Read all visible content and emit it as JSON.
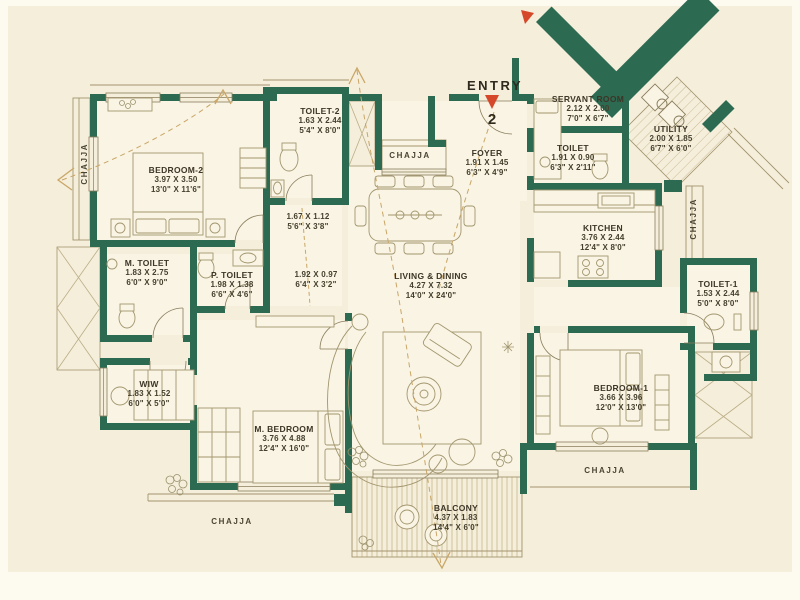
{
  "plan": {
    "entry": {
      "label": "ENTRY",
      "number": "2"
    },
    "rooms": [
      {
        "id": "bedroom-2",
        "name": "BEDROOM-2",
        "metric": "3.97 X 3.50",
        "imperial": "13'0\" X 11'6\""
      },
      {
        "id": "toilet-2",
        "name": "TOILET-2",
        "metric": "1.63 X 2.44",
        "imperial": "5'4\" X 8'0\""
      },
      {
        "id": "servant-room",
        "name": "SERVANT ROOM",
        "metric": "2.12 X 2.00",
        "imperial": "7'0\" X 6'7\""
      },
      {
        "id": "foyer",
        "name": "FOYER",
        "metric": "1.91 X 1.45",
        "imperial": "6'3\" X 4'9\""
      },
      {
        "id": "toilet",
        "name": "TOILET",
        "metric": "1.91 X 0.90",
        "imperial": "6'3\" X 2'11\""
      },
      {
        "id": "utility",
        "name": "UTILITY",
        "metric": "2.00 X 1.85",
        "imperial": "6'7\" X 6'0\""
      },
      {
        "id": "kitchen",
        "name": "KITCHEN",
        "metric": "3.76 X 2.44",
        "imperial": "12'4\" X 8'0\""
      },
      {
        "id": "toilet-1",
        "name": "TOILET-1",
        "metric": "1.53 X 2.44",
        "imperial": "5'0\" X 8'0\""
      },
      {
        "id": "bedroom-1",
        "name": "BEDROOM-1",
        "metric": "3.66 X 3.96",
        "imperial": "12'0\" X 13'0\""
      },
      {
        "id": "living-dining",
        "name": "LIVING & DINING",
        "metric": "4.27 X 7.32",
        "imperial": "14'0\" X 24'0\""
      },
      {
        "id": "m-toilet",
        "name": "M. TOILET",
        "metric": "1.83 X 2.75",
        "imperial": "6'0\" X 9'0\""
      },
      {
        "id": "p-toilet",
        "name": "P. TOILET",
        "metric": "1.98 X 1.38",
        "imperial": "6'6\" X 4'6\""
      },
      {
        "id": "wiw",
        "name": "WIW",
        "metric": "1.83 X 1.52",
        "imperial": "6'0\" X 5'0\""
      },
      {
        "id": "m-bedroom",
        "name": "M. BEDROOM",
        "metric": "3.76 X 4.88",
        "imperial": "12'4\" X 16'0\""
      },
      {
        "id": "balcony",
        "name": "BALCONY",
        "metric": "4.37 X 1.83",
        "imperial": "14'4\" X 6'0\""
      }
    ],
    "passages": [
      {
        "id": "passage-1",
        "metric": "1.67 X 1.12",
        "imperial": "5'6\" X 3'8\""
      },
      {
        "id": "passage-2",
        "metric": "1.92 X 0.97",
        "imperial": "6'4\" X 3'2\""
      }
    ],
    "chajja": {
      "left": "CHAJJA",
      "top": "CHAJJA",
      "right": "CHAJJA",
      "bottom_left": "CHAJJA",
      "bottom_right": "CHAJJA"
    },
    "colors": {
      "wall": "#2d6a52",
      "background": "#f5eedb",
      "accent_red": "#d6482a",
      "line": "#a2946e",
      "text": "#3d3526"
    }
  }
}
